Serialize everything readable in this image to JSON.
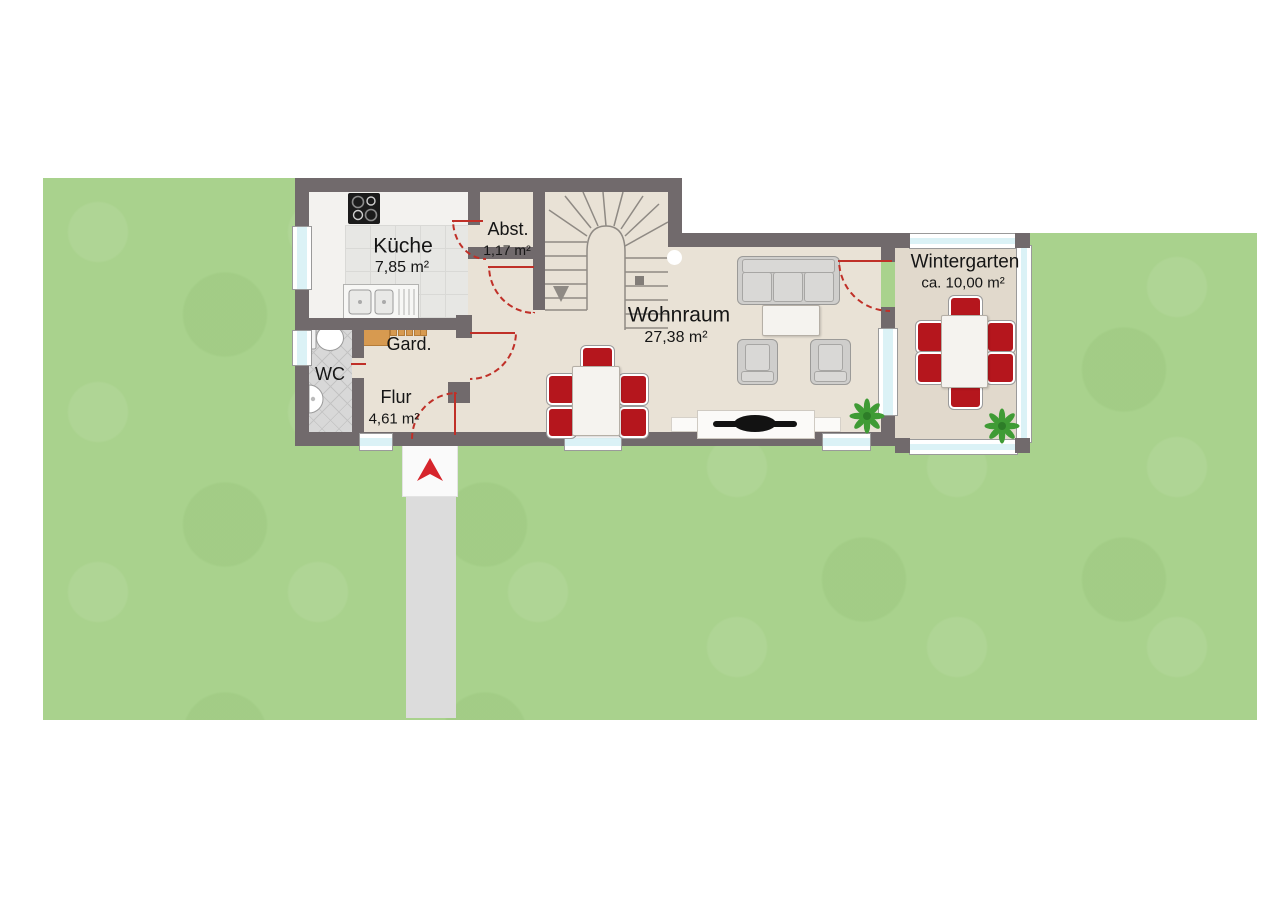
{
  "plan_type": "ground-floor-plan",
  "rooms": {
    "kueche": {
      "label": "Küche",
      "area": "7,85 m²"
    },
    "abst": {
      "label": "Abst.",
      "area": "1,17 m²"
    },
    "wohnraum": {
      "label": "Wohnraum",
      "area": "27,38 m²"
    },
    "wintergarten": {
      "label": "Wintergarten",
      "area": "ca. 10,00 m²"
    },
    "gard": {
      "label": "Gard."
    },
    "wc": {
      "label": "WC"
    },
    "flur": {
      "label": "Flur",
      "area": "4,61 m²"
    }
  },
  "icons": {
    "entrance_arrow": "red-triangle-up",
    "stairs": "u-shaped-winder-stair",
    "plant": "leaf-starburst",
    "toilet": "toilet-top-view",
    "sink": "double-sink-with-drainer",
    "cooktop": "four-burner-hob",
    "tv": "flatscreen-on-sideboard",
    "coat_rack": "wardrobe-rack"
  },
  "colors": {
    "lawn": "#a9d28d",
    "wall": "#716a6c",
    "floor": "#e9e2d6",
    "wintergarten_floor": "#e1d9cc",
    "accent_red": "#c03028",
    "chair_red": "#b5161d",
    "glass": "#dbf2f6",
    "path": "#dcdcdc",
    "wood": "#d79a50",
    "plant_green": "#3f9b35"
  }
}
